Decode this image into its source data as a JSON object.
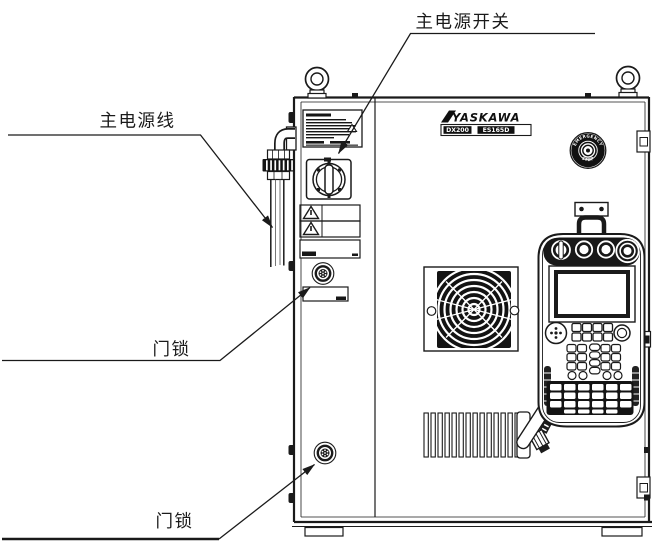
{
  "figure": {
    "callouts": {
      "main_power_switch": "主电源开关",
      "main_power_cable": "主电源线",
      "door_lock_upper": "门锁",
      "door_lock_lower": "门锁"
    },
    "cabinet": {
      "brand_logo": "YASKAWA",
      "nameplate": {
        "controller_model": "DX200",
        "robot_model": "ES165D"
      },
      "emergency_stop_button": {
        "top_text": "EMERGENCY",
        "bottom_text": "STOP"
      }
    }
  }
}
